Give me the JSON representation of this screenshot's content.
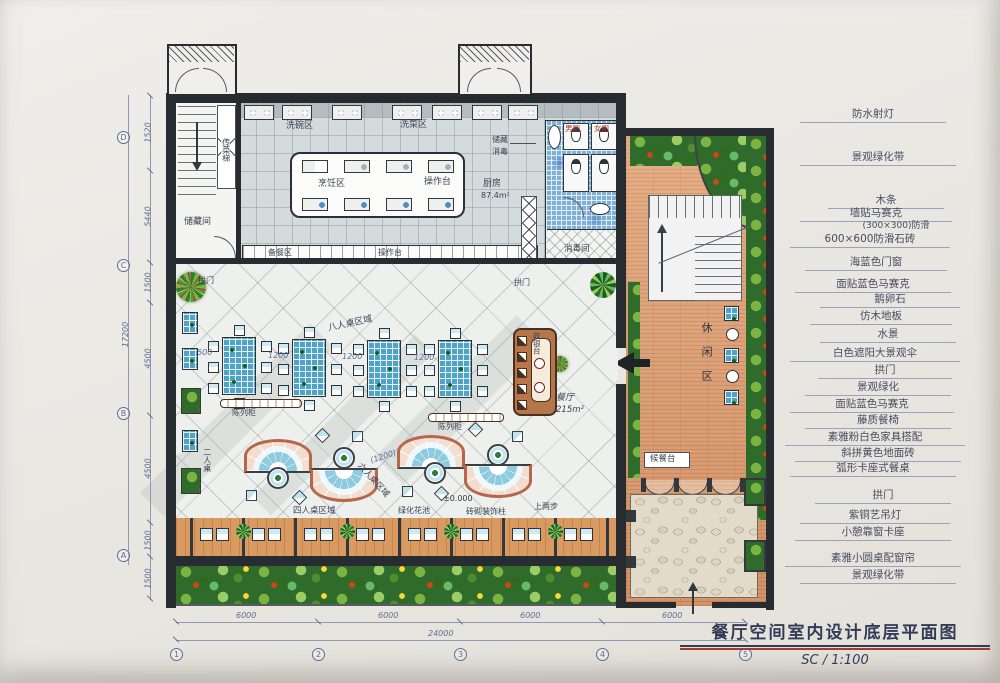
{
  "colors": {
    "paper": "#eae8e3",
    "wall": "#272c31",
    "ink": "#3d4254",
    "dim-blue": "#5d6d94",
    "water-blue": "#4fa3c7",
    "terracotta": "#dc9d72",
    "foliage": "#2f6b2a",
    "salmon": "#b4674b",
    "title-red": "#a33c2e"
  },
  "title": {
    "main": "餐厅空间室内设计底层平面图",
    "scale": "SC / 1:100"
  },
  "ann": [
    "防水射灯",
    "景观绿化带",
    "木条",
    "墙贴马赛克",
    "(300×300)防滑",
    "600×600防滑石砖",
    "海蓝色门窗",
    "面贴蓝色马赛克",
    "鹅卵石",
    "仿木地板",
    "水景",
    "白色遮阳大景观伞",
    "拱门",
    "景观绿化",
    "面贴蓝色马赛克",
    "藤质餐椅",
    "素雅粉白色家具搭配",
    "斜拼黄色地面砖",
    "弧形卡座式餐桌",
    "拱门",
    "紫铜艺吊灯",
    "小憩靠窗卡座",
    "素雅小圆桌配窗帘",
    "景观绿化带"
  ],
  "plan": {
    "xiwanqu": "洗碗区",
    "xicaiqu": "洗菜区",
    "pengrenqu": "烹饪区",
    "caozuotai": "操作台",
    "chufang": "厨房",
    "chufang_area": "87.4m²",
    "chucang": "储藏",
    "xiaodu": "消毒",
    "beicanqu": "备餐区",
    "chuancaiti": "传菜梯",
    "chucangjian": "储藏间",
    "xiaodujian": "消毒间",
    "nance": "男厕",
    "nvce": "女厕",
    "gongmen": "拱门",
    "canting": "餐厅",
    "canting_area": "215m²",
    "shouyintai": "收银台",
    "chenliegui": "陈列柜",
    "zone8": "八人桌区域",
    "zone6": "六人桌区域",
    "zone4": "四人桌区域",
    "zone2": "二人桌",
    "xiuxianqu": "休闲区",
    "houcantai": "候餐台",
    "lvhuahuachi": "绿化花池",
    "zhuangshizhu": "砖砌装饰柱",
    "shangliangbu": "上两步",
    "level": "±0.000",
    "booth_dim": "(1200)"
  },
  "dims": {
    "m6000": "6000",
    "m24000": "24000",
    "t1500": "1500",
    "t1200": "1200",
    "l1520": "1520",
    "l5440": "5440",
    "l1500": "1500",
    "l4500": "4500",
    "l17200": "17200"
  },
  "grid": {
    "n1": "1",
    "n2": "2",
    "n3": "3",
    "n4": "4",
    "n5": "5",
    "lA": "A",
    "lB": "B",
    "lC": "C",
    "lD": "D"
  }
}
